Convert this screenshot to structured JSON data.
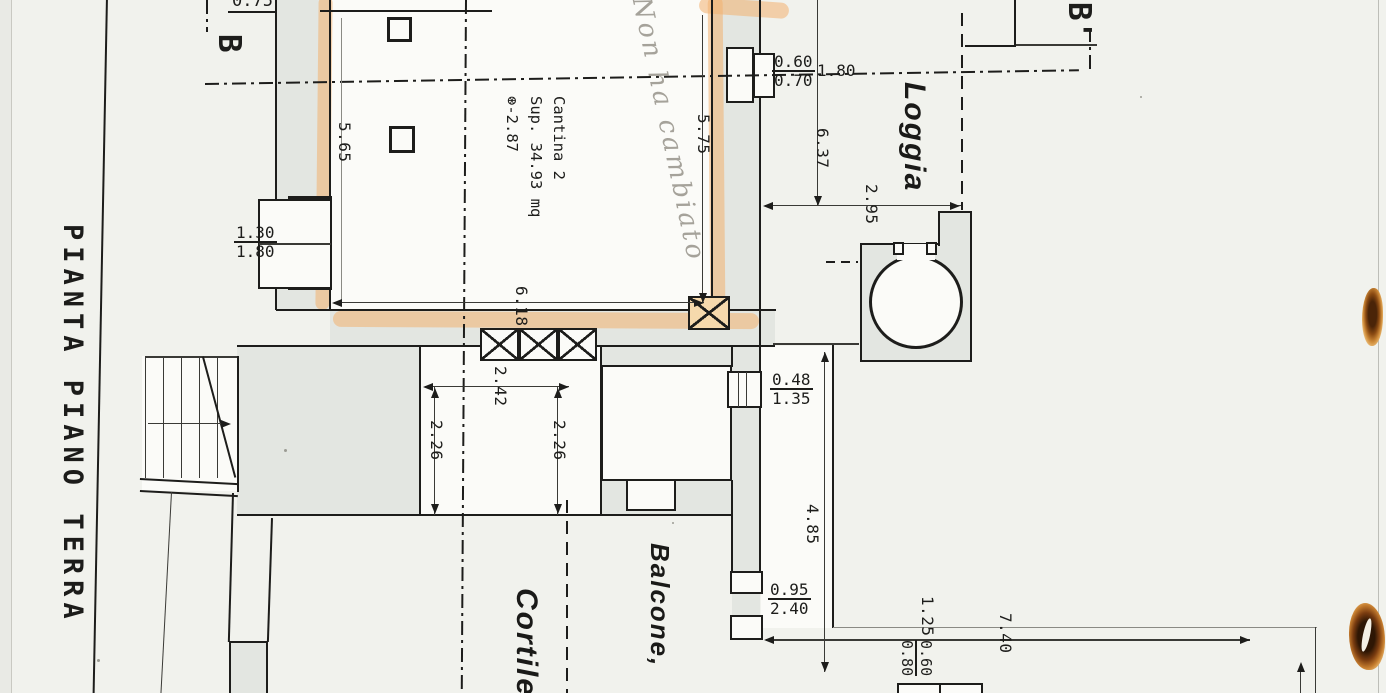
{
  "title": "PIANTA PIANO TERRA",
  "section_markers": {
    "left": "B",
    "right": "B'"
  },
  "room_labels": {
    "cantina_line1": "Cantina 2",
    "cantina_line2": "Sup. 34.93 mq",
    "cantina_line3": "⊛-2.87",
    "loggia": "Loggia",
    "balcone": "Balcone,",
    "cortile": "Cortile"
  },
  "handwritten_note": "Non ha cambiato",
  "dimensions": {
    "top_left_partial": "0.75",
    "cantina_left_height": "5.65",
    "cantina_right_height": "5.75",
    "cantina_width": "6.18",
    "left_window": {
      "num": "1.30",
      "den": "1.80"
    },
    "top_door": {
      "num": "0.60",
      "den": "0.70"
    },
    "door_offset": "1.80",
    "loggia_depth": "6.37",
    "loggia_width": "2.95",
    "terrace_width": "2.42",
    "terrace_height_left": "2.26",
    "terrace_height_right": "2.26",
    "mid_window": {
      "num": "0.48",
      "den": "1.35"
    },
    "corridor_length": "4.85",
    "balcony_door": {
      "num": "0.95",
      "den": "2.40"
    },
    "gap_right": "1.25",
    "bottom_right_frac": {
      "num": "0.60",
      "den": "0.80"
    },
    "courtyard_width": "7.40"
  },
  "colors": {
    "paper": "#f1f2ed",
    "ink": "#1d1d1b",
    "wall_fill": "#e3e6e1",
    "highlighter": "#f2b170",
    "pencil": "#a5a29a",
    "stain": "#7a3c10"
  }
}
